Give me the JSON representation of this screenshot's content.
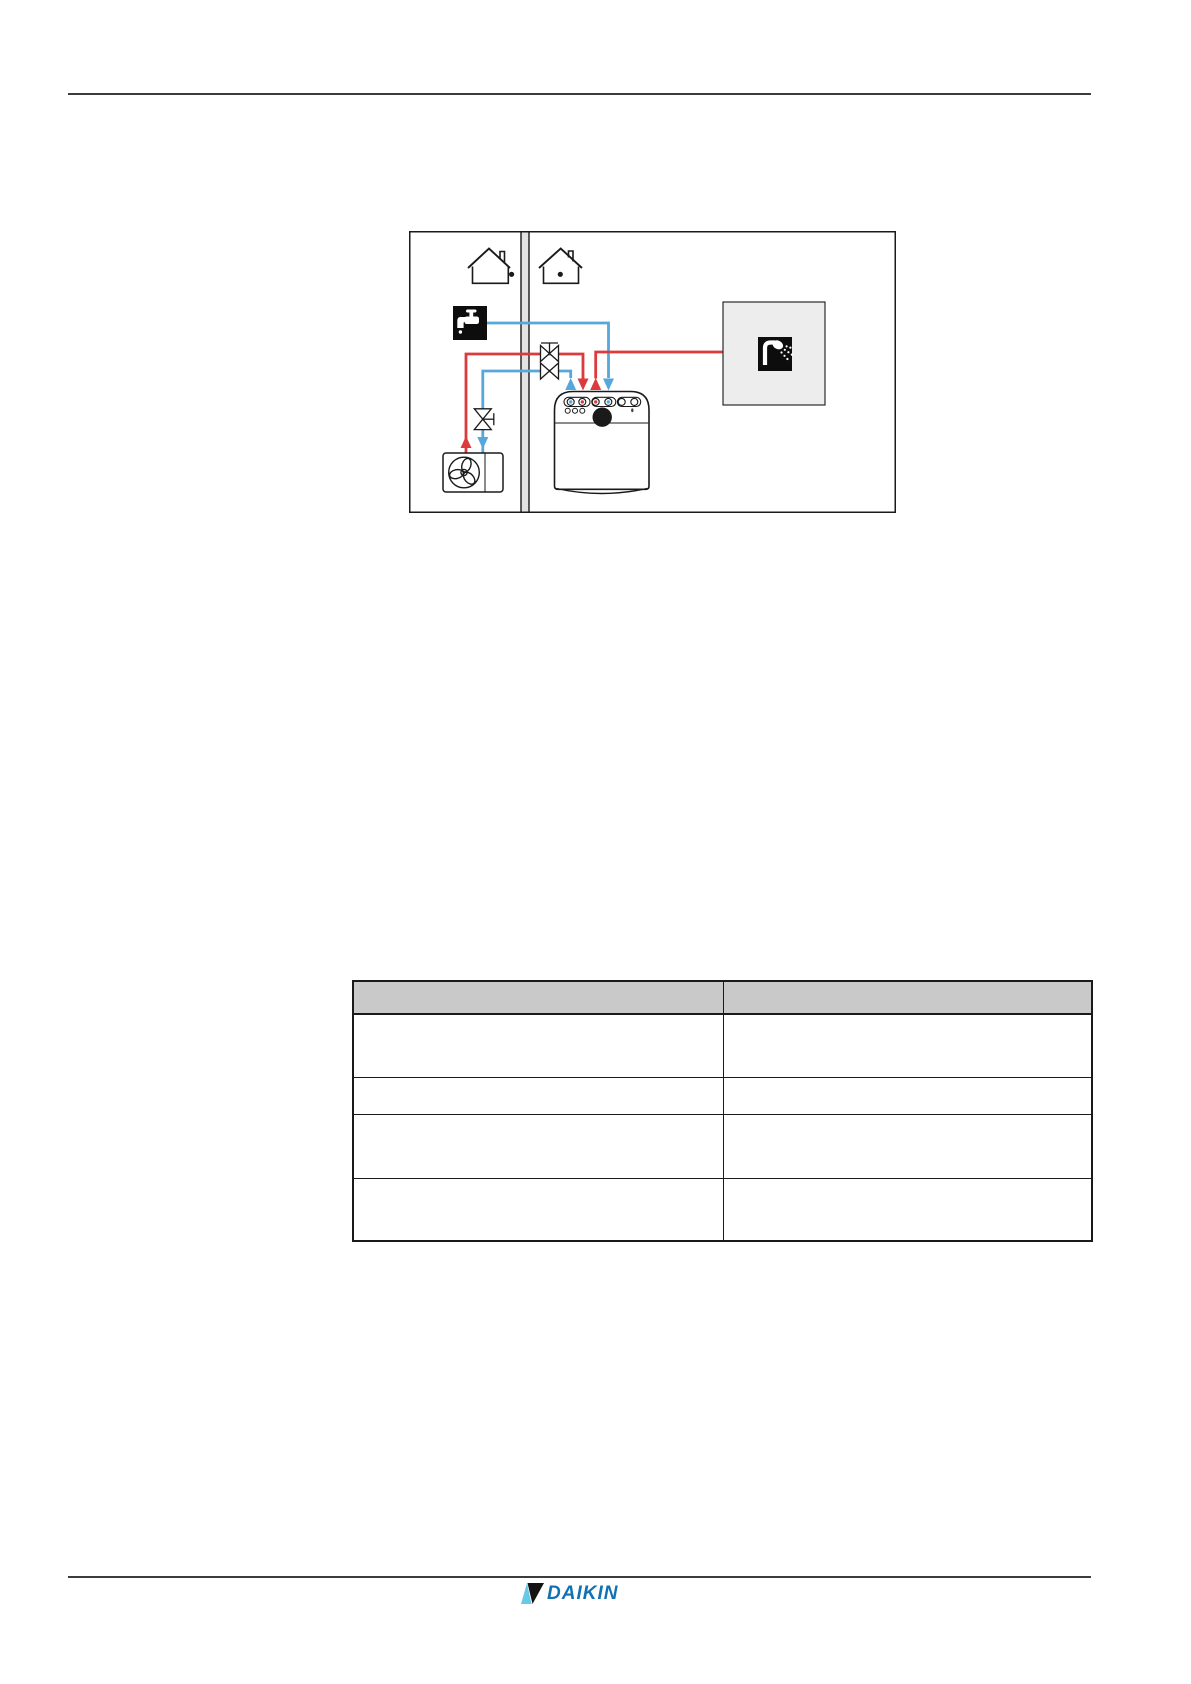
{
  "colors": {
    "hot": "#dd3a3c",
    "cold": "#56a7db",
    "ink": "#1a1a1a",
    "rule": "#3c3c3c",
    "wall_fill": "#e3e3e3",
    "panel_gray": "#ededed",
    "icon_bg": "#0d0d0d",
    "table_header": "#c9c9c9",
    "daikin_blue": "#1171b5",
    "daikin_cyan": "#67c9e6"
  },
  "icons": {
    "outdoor_house": "house-outdoor-icon",
    "indoor_house": "house-indoor-icon",
    "cold_tap": "cold-water-tap-icon",
    "shower": "shower-icon",
    "fan": "fan-icon",
    "valve": "shutoff-valve-icon"
  },
  "diagram": {
    "description_visible_text": ""
  },
  "table": {
    "headers": [
      "",
      ""
    ],
    "rows": [
      [
        "",
        ""
      ],
      [
        "",
        ""
      ],
      [
        "",
        ""
      ],
      [
        "",
        ""
      ]
    ]
  },
  "footer": {
    "brand": "DAIKIN"
  }
}
